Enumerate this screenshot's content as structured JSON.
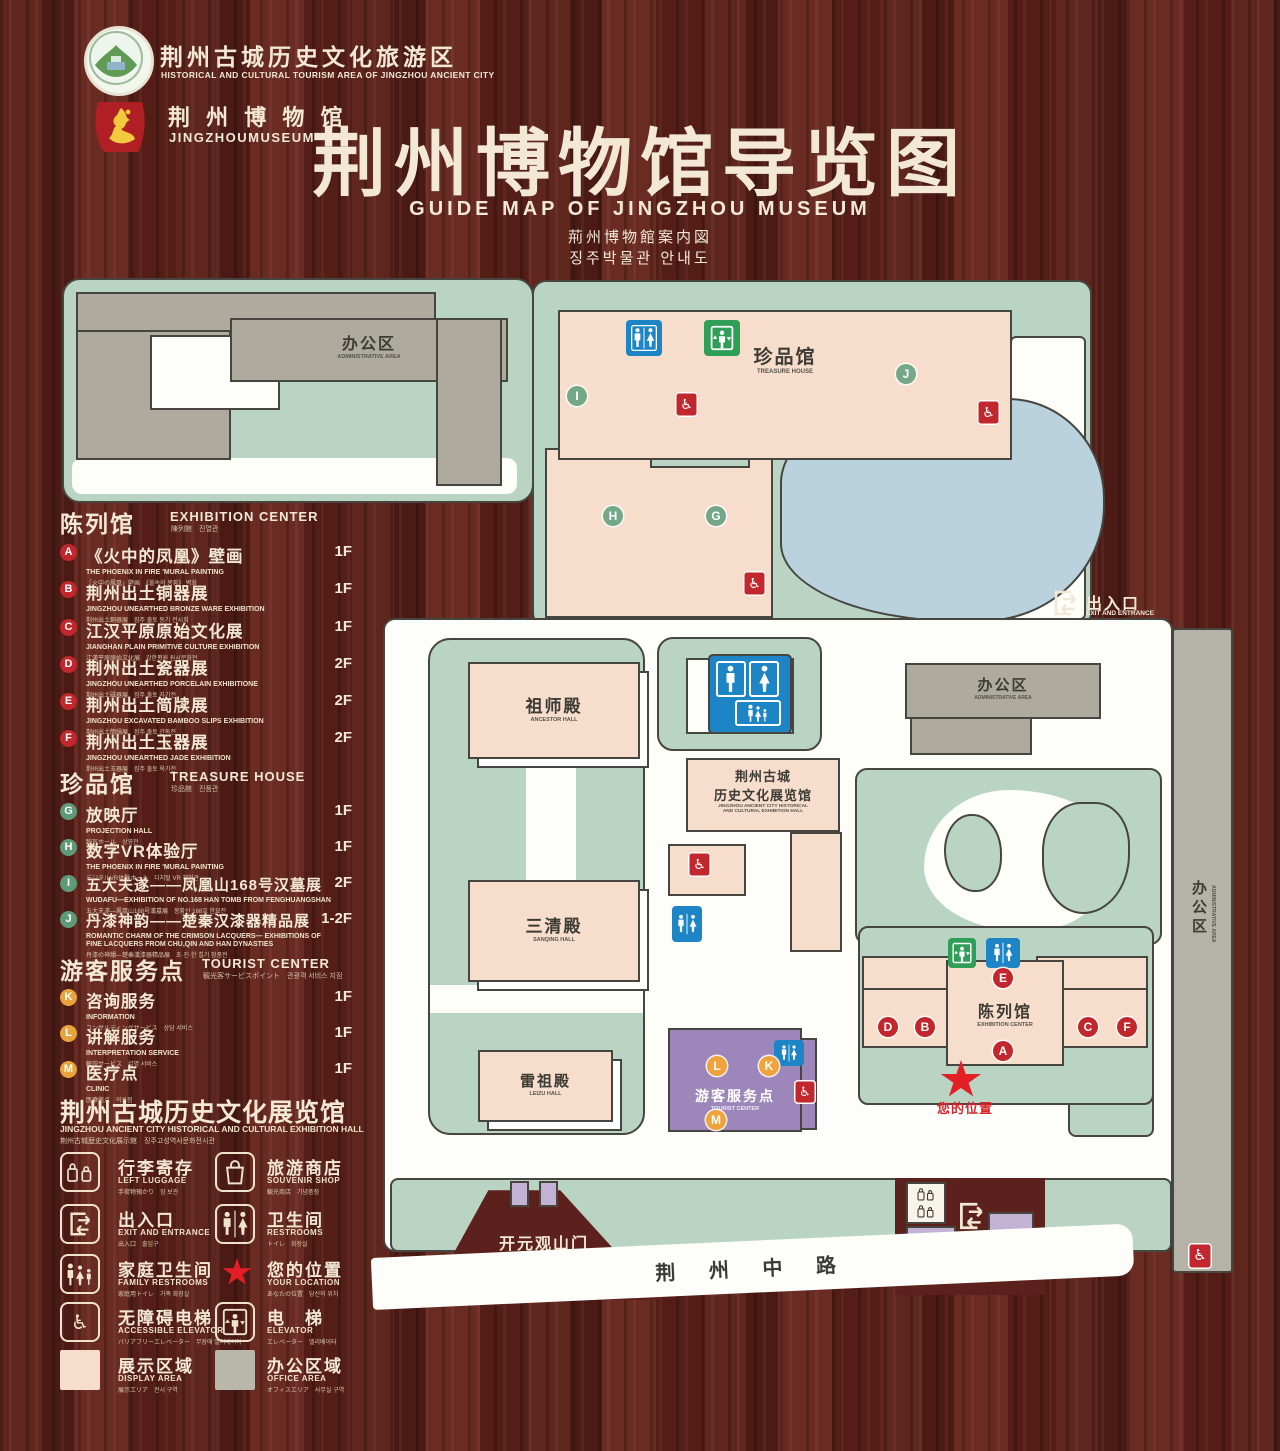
{
  "colors": {
    "wood": "#571f18",
    "map_green": "#bad4c4",
    "building_pink": "#f7ddcb",
    "building_gray": "#aeaa9e",
    "pond_blue": "#b9d2de",
    "tourist_purple": "#9d86ba",
    "gate_purple": "#c3b2d4",
    "marker_red": "#c1272d",
    "marker_green": "#74a888",
    "marker_orange": "#f0a23b",
    "star_red": "#e31e25",
    "text_cream": "#f2e8d4"
  },
  "header": {
    "logo1": {
      "zh": "荆州古城历史文化旅游区",
      "en": "HISTORICAL AND CULTURAL TOURISM AREA OF JINGZHOU ANCIENT CITY"
    },
    "logo2": {
      "zh": "荆 州 博 物 馆",
      "en": "JINGZHOUMUSEUM"
    },
    "title_zh": "荆州博物馆导览图",
    "title_en": "GUIDE MAP OF JINGZHOU MUSEUM",
    "title_ja": "荊州博物館案内図",
    "title_ko": "징주박물관 안내도"
  },
  "legend": {
    "sections": [
      {
        "title_zh": "陈列馆",
        "title_en": "EXHIBITION CENTER",
        "title_sub": "陳列館　진열관",
        "items": [
          {
            "letter": "A",
            "zh": "《火中的凤凰》壁画",
            "en": "THE PHOENIX IN FIRE 'MURAL PAINTING",
            "sub": "「火中の鳳凰」壁画　《불속의 봉황》 벽화",
            "floor": "1F"
          },
          {
            "letter": "B",
            "zh": "荆州出土铜器展",
            "en": "JINGZHOU UNEARTHED BRONZE WARE EXHIBITION",
            "sub": "荆州出土銅器展　징주 출토 동기 전시회",
            "floor": "1F"
          },
          {
            "letter": "C",
            "zh": "江汉平原原始文化展",
            "en": "JIANGHAN PLAIN PRIMITIVE CULTURE EXHIBITION",
            "sub": "江漢平原原始文化展　강한평원 원시문화전",
            "floor": "1F"
          },
          {
            "letter": "D",
            "zh": "荆州出土瓷器展",
            "en": "JINGZHOU UNEARTHED PORCELAIN EXHIBITIONE",
            "sub": "荆州出土磁器展　징주 출토 자기전",
            "floor": "2F"
          },
          {
            "letter": "E",
            "zh": "荆州出土简牍展",
            "en": "JINGZHOU EXCAVATED BAMBOO SLIPS EXHIBITION",
            "sub": "荆州出土簡牘展　징주 출토 간독전",
            "floor": "2F"
          },
          {
            "letter": "F",
            "zh": "荆州出土玉器展",
            "en": "JINGZHOU UNEARTHED JADE EXHIBITION",
            "sub": "荆州出土玉器展　징주 출토 옥기전",
            "floor": "2F"
          }
        ]
      },
      {
        "title_zh": "珍品馆",
        "title_en": "TREASURE HOUSE",
        "title_sub": "珍品館　진품관",
        "items": [
          {
            "letter": "G",
            "zh": "放映厅",
            "en": "PROJECTION HALL",
            "sub": "映写ホール　상영관",
            "floor": "1F"
          },
          {
            "letter": "H",
            "zh": "数字VR体验厅",
            "en": "THE PHOENIX IN FIRE 'MURAL PAINTING",
            "sub": "デジタルVR体験ホール　디지털 VR 체험관",
            "floor": "1F"
          },
          {
            "letter": "I",
            "zh": "五大夫遂——凤凰山168号汉墓展",
            "en": "WUDAFU—EXHIBITION OF NO.168 HAN TOMB FROM FENGHUANGSHAN",
            "sub": "五大夫遂—鳳凰山168号漢墓展　봉황산 168호 한묘전",
            "floor": "2F"
          },
          {
            "letter": "J",
            "zh": "丹漆神韵——楚秦汉漆器精品展",
            "en": "ROMANTIC CHARM OF THE CRIMSON LACQUERS— EXHIBITIONS OF FINE LACQUERS FROM CHU,QIN AND HAN DYNASTIES",
            "sub": "丹漆の神韻—楚秦漢漆器精品展　초·진·한 칠기 정품전",
            "floor": "1-2F"
          }
        ]
      },
      {
        "title_zh": "游客服务点",
        "title_en": "TOURIST CENTER",
        "title_sub": "観光客サービスポイント　관광객 서비스 지점",
        "items": [
          {
            "letter": "K",
            "zh": "咨询服务",
            "en": "INFORMATION",
            "sub": "コンサルティングサービス　상담 서비스",
            "floor": "1F"
          },
          {
            "letter": "L",
            "zh": "讲解服务",
            "en": "INTERPRETATION SERVICE",
            "sub": "解説サービス　설명 서비스",
            "floor": "1F"
          },
          {
            "letter": "M",
            "zh": "医疗点",
            "en": "CLINIC",
            "sub": "医療拠点　의료점",
            "floor": "1F"
          }
        ]
      }
    ],
    "hall_note": {
      "zh": "荆州古城历史文化展览馆",
      "en": "JINGZHOU ANCIENT CITY HISTORICAL AND CULTURAL EXHIBITION HALL",
      "sub": "荆州古城歴史文化展示館　징주고성역사문화전시관"
    },
    "icons": [
      {
        "name": "left-luggage",
        "zh": "行李寄存",
        "en": "LEFT LUGGAGE",
        "sub": "手荷物預かり　짐 보관"
      },
      {
        "name": "souvenir-shop",
        "zh": "旅游商店",
        "en": "SOUVENIR SHOP",
        "sub": "観光商店　기념품점"
      },
      {
        "name": "exit-entrance",
        "zh": "出入口",
        "en": "EXIT AND ENTRANCE",
        "sub": "出入口　출입구"
      },
      {
        "name": "restrooms",
        "zh": "卫生间",
        "en": "RESTROOMS",
        "sub": "トイレ　화장실"
      },
      {
        "name": "family-restrooms",
        "zh": "家庭卫生间",
        "en": "FAMILY RESTROOMS",
        "sub": "家庭用トイレ　가족 화장실"
      },
      {
        "name": "your-location",
        "zh": "您的位置",
        "en": "YOUR LOCATION",
        "sub": "あなたの位置　당신의 위치"
      },
      {
        "name": "accessible-elevator",
        "zh": "无障碍电梯",
        "en": "ACCESSIBLE ELEVATOR",
        "sub": "バリアフリーエレベーター　무장애 엘리베이터"
      },
      {
        "name": "elevator",
        "zh": "电　梯",
        "en": "ELEVATOR",
        "sub": "エレベーター　엘리베이터"
      }
    ],
    "areas": [
      {
        "zh": "展示区域",
        "en": "DISPLAY AREA",
        "sub": "展示エリア　전시 구역",
        "color": "#f7ddcb"
      },
      {
        "zh": "办公区域",
        "en": "OFFICE AREA",
        "sub": "オフィスエリア　사무실 구역",
        "color": "#b9b6aa"
      }
    ]
  },
  "map": {
    "admin_top": {
      "zh": "办公区",
      "en": "ADMINISTRATIVE AREA"
    },
    "treasure": {
      "zh": "珍品馆",
      "en": "TREASURE HOUSE"
    },
    "ancestor": {
      "zh": "祖师殿",
      "en": "ANCESTOR HALL"
    },
    "sanqing": {
      "zh": "三清殿",
      "en": "SANQING HALL"
    },
    "leizu": {
      "zh": "雷祖殿",
      "en": "LEIZU HALL"
    },
    "hist": {
      "zh1": "荆州古城",
      "zh2": "历史文化展览馆",
      "en1": "JINGZHOU ANCIENT CITY HISTORICAL",
      "en2": "AND CULTURAL EXHIBITION HALL"
    },
    "admin_right": {
      "zh": "办公区",
      "en": "ADMINISTRATIVE AREA"
    },
    "admin_strip": {
      "zh": "办公区",
      "en": "ADMINISTRATIVE AREA"
    },
    "exhibition": {
      "zh": "陈列馆",
      "en": "EXHIBITION CENTER"
    },
    "tourist": {
      "zh": "游客服务点",
      "en": "TOURIST CENTER"
    },
    "your_location": "您的位置",
    "gate": {
      "zh": "开元观山门",
      "en": "KAIYUAN TEMPLE GATE"
    },
    "exit_top": {
      "zh": "出入口",
      "en": "EXIT AND ENTRANCE"
    },
    "exit_bottom": {
      "zh": "出入口",
      "en": "EXIT AND ENTRANCE"
    },
    "road": "荆 州 中 路",
    "markers": [
      {
        "letter": "I",
        "kind": "treasure-house"
      },
      {
        "letter": "J",
        "kind": "treasure-house"
      },
      {
        "letter": "H",
        "kind": "treasure-house"
      },
      {
        "letter": "G",
        "kind": "treasure-house"
      },
      {
        "letter": "E",
        "kind": "exhibition-center"
      },
      {
        "letter": "D",
        "kind": "exhibition-center"
      },
      {
        "letter": "B",
        "kind": "exhibition-center"
      },
      {
        "letter": "C",
        "kind": "exhibition-center"
      },
      {
        "letter": "F",
        "kind": "exhibition-center"
      },
      {
        "letter": "A",
        "kind": "exhibition-center"
      },
      {
        "letter": "L",
        "kind": "tourist-center"
      },
      {
        "letter": "K",
        "kind": "tourist-center"
      },
      {
        "letter": "M",
        "kind": "tourist-center"
      }
    ]
  }
}
